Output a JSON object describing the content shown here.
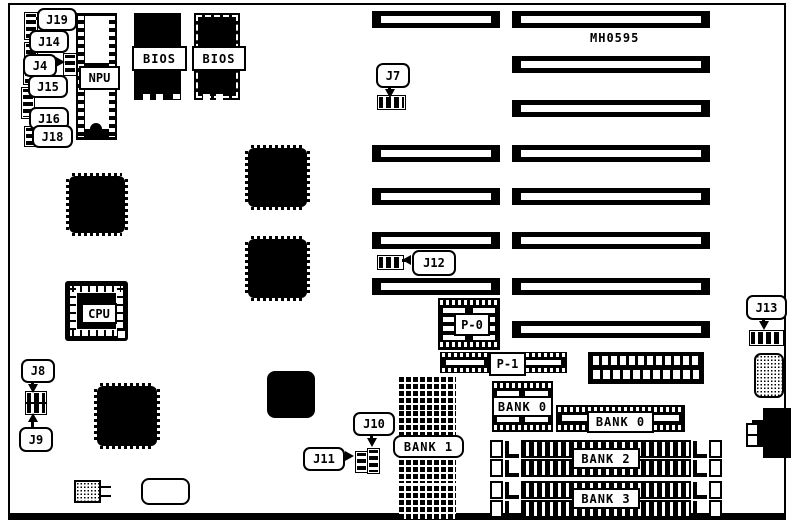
{
  "diagram": {
    "part_number": "MH0595"
  },
  "chips": {
    "npu_label": "NPU",
    "cpu_label": "CPU",
    "bios1_label": "BIOS",
    "bios2_label": "BIOS"
  },
  "jumpers": {
    "j4": "J4",
    "j7": "J7",
    "j8": "J8",
    "j9": "J9",
    "j10": "J10",
    "j11": "J11",
    "j12": "J12",
    "j13": "J13",
    "j14": "J14",
    "j15": "J15",
    "j16": "J16",
    "j18": "J18",
    "j19": "J19"
  },
  "power_connectors": {
    "p0": "P-0",
    "p1": "P-1"
  },
  "memory_banks": {
    "bank0_a": "BANK 0",
    "bank0_b": "BANK 0",
    "bank1": "BANK 1",
    "bank2": "BANK 2",
    "bank3": "BANK 3"
  }
}
